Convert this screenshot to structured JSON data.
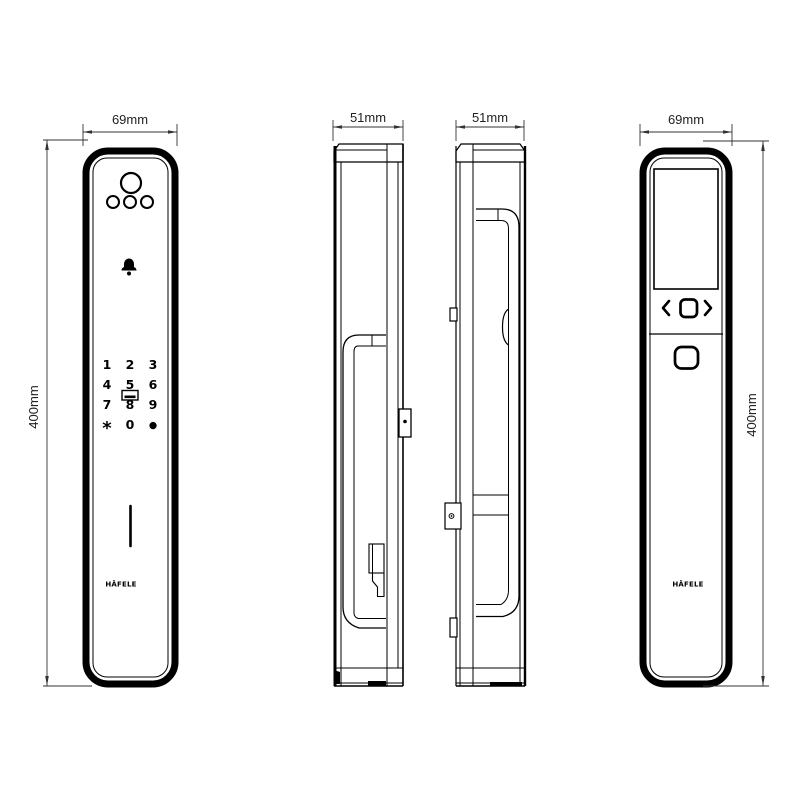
{
  "canvas": {
    "background": "#ffffff",
    "line_color": "#000000",
    "dimension_color": "#333333"
  },
  "dimensions": {
    "front_width": "69mm",
    "front_height": "400mm",
    "exterior_side_depth": "51mm",
    "interior_side_depth": "51mm",
    "back_width": "69mm",
    "back_height": "400mm"
  },
  "front_view": {
    "logo": "HÄFELE",
    "keypad_keys": [
      "1",
      "2",
      "3",
      "4",
      "5",
      "6",
      "7",
      "8",
      "9",
      "*",
      "0",
      "●"
    ]
  },
  "back_view": {
    "logo": "HÄFELE"
  },
  "icons": {
    "camera-icon": "circle lens",
    "sensor-dots-icon": "three circles",
    "doorbell-icon": "bell glyph",
    "card-reader-icon": "card slot rectangle",
    "speaker-slot-icon": "vertical slot",
    "latch-bolt-icon": "protruding bolt",
    "key-cover-icon": "emergency key cover",
    "screw-hole-icon": "mount tab with screw",
    "chevron-left-icon": "‹",
    "menu-square-icon": "▢",
    "chevron-right-icon": "›",
    "power-button-icon": "rounded square button"
  }
}
